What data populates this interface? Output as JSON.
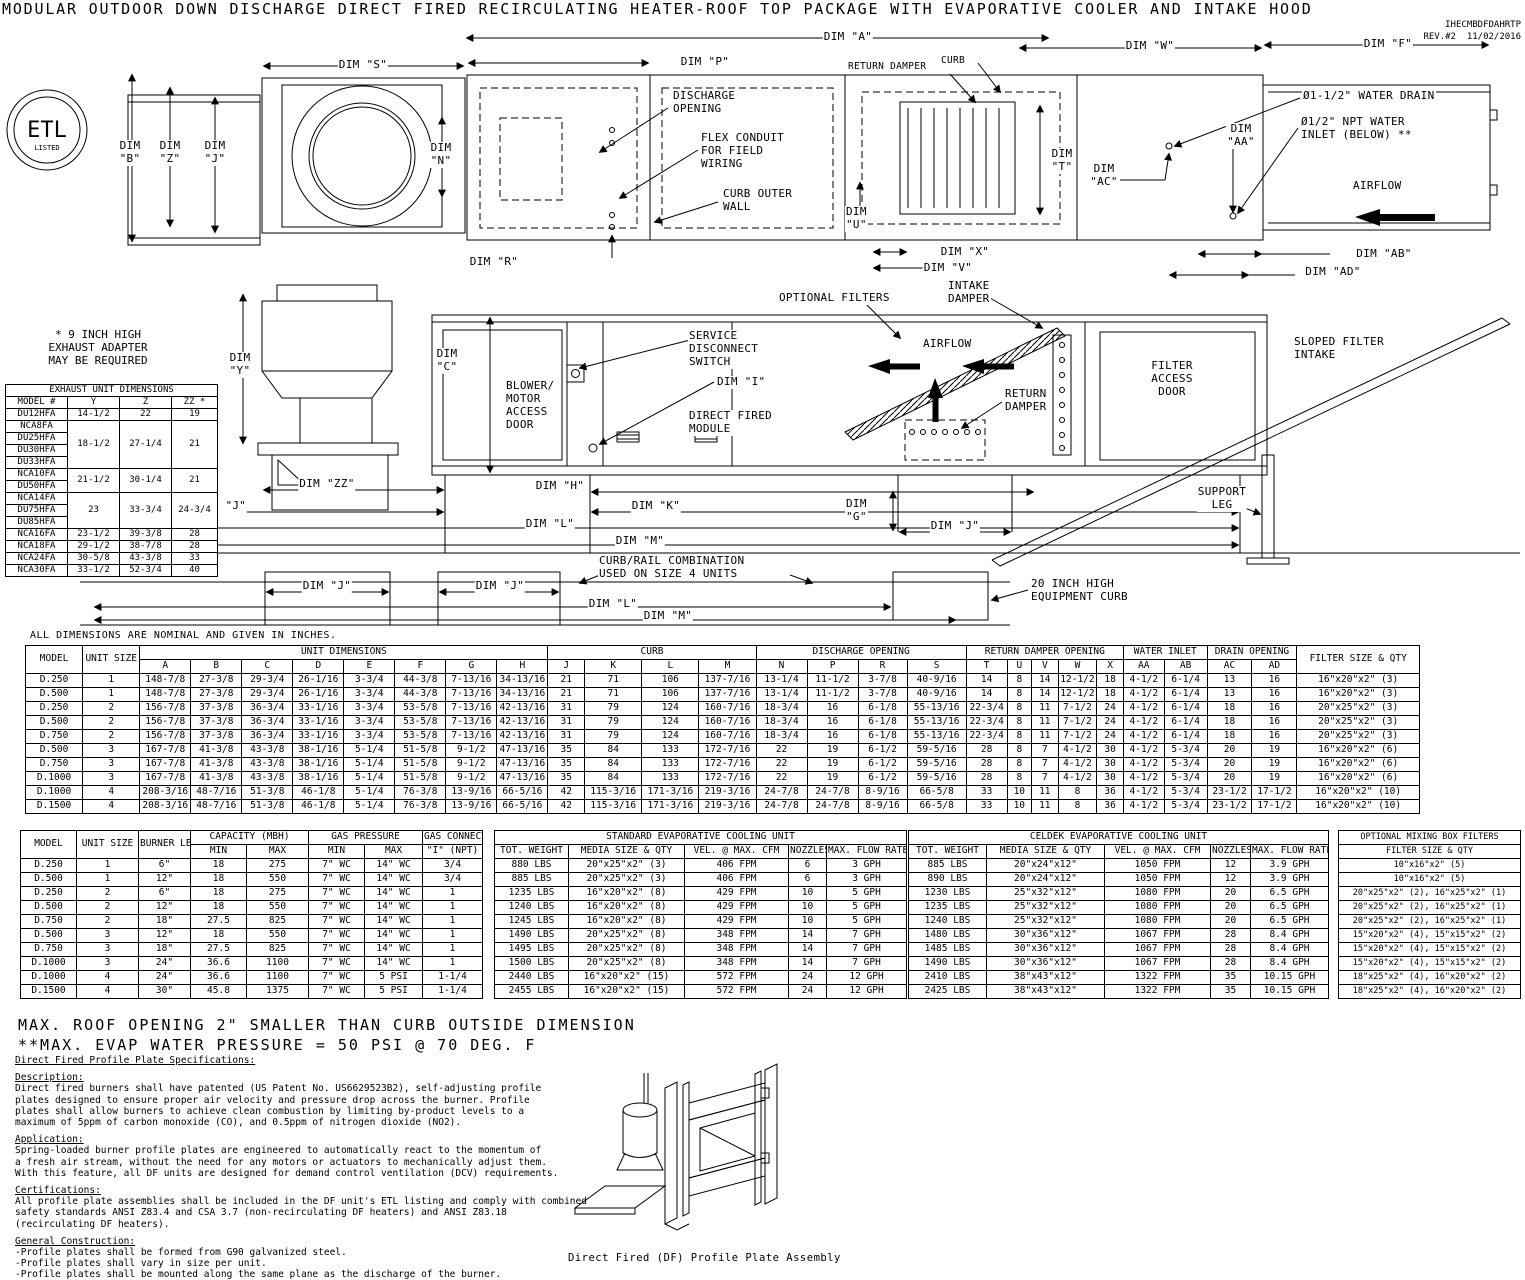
{
  "doc": {
    "title": "MODULAR OUTDOOR DOWN DISCHARGE DIRECT FIRED RECIRCULATING HEATER-ROOF TOP PACKAGE WITH EVAPORATIVE COOLER AND INTAKE HOOD",
    "ref": "IHECMBDFDAHRTP",
    "rev": "REV.#2",
    "date": "11/02/2016"
  },
  "top": {
    "dim_a": "DIM \"A\"",
    "dim_s": "DIM \"S\"",
    "dim_p": "DIM \"P\"",
    "return_damper": "RETURN DAMPER",
    "curb": "CURB",
    "dim_w": "DIM \"W\"",
    "dim_f": "DIM \"F\"",
    "dim_b": "DIM\n\"B\"",
    "dim_z": "DIM\n\"Z\"",
    "dim_j": "DIM\n\"J\"",
    "dim_n": "DIM\n\"N\"",
    "discharge_opening": "DISCHARGE\nOPENING",
    "flex_conduit": "FLEX CONDUIT\nFOR FIELD\nWIRING",
    "curb_outer_wall": "CURB OUTER\nWALL",
    "dim_t": "DIM\n\"T\"",
    "dim_ac": "DIM\n\"AC\"",
    "dim_aa": "DIM\n\"AA\"",
    "water_drain": "Ø1-1/2\" WATER DRAIN",
    "water_inlet": "Ø1/2\" NPT WATER\nINLET (BELOW) **",
    "airflow": "AIRFLOW",
    "dim_u": "DIM\n\"U\"",
    "dim_r": "DIM \"R\"",
    "dim_x": "DIM \"X\"",
    "dim_v": "DIM \"V\"",
    "dim_ab": "DIM \"AB\"",
    "dim_ad": "DIM \"AD\"",
    "etl_main": "ETL",
    "etl_sub": "LISTED"
  },
  "side": {
    "exhaust_note": "* 9 INCH HIGH\nEXHAUST ADAPTER\nMAY BE REQUIRED",
    "optional_filters": "OPTIONAL FILTERS",
    "intake_damper": "INTAKE\nDAMPER",
    "sloped_filter_intake": "SLOPED FILTER\nINTAKE",
    "dim_y": "DIM\n\"Y\"",
    "dim_c": "DIM\n\"C\"",
    "blower_door": "BLOWER/\nMOTOR\nACCESS\nDOOR",
    "service_switch": "SERVICE\nDISCONNECT\nSWITCH",
    "dim_i": "DIM \"I\"",
    "df_module": "DIRECT FIRED\nMODULE",
    "airflow": "AIRFLOW",
    "return_damper": "RETURN\nDAMPER",
    "filter_door": "FILTER\nACCESS\nDOOR",
    "support_leg": "SUPPORT\nLEG",
    "dim_zz": "DIM \"ZZ\"",
    "dim_h": "DIM \"H\"",
    "dim_j1": "DIM \"J\"",
    "dim_k": "DIM \"K\"",
    "dim_g": "DIM\n\"G\"",
    "dim_j2": "DIM \"J\"",
    "dim_l": "DIM \"L\"",
    "dim_m": "DIM \"M\"",
    "curb_rail": "CURB/RAIL COMBINATION\nUSED ON SIZE 4 UNITS",
    "dim_j3": "DIM \"J\"",
    "dim_j4": "DIM \"J\"",
    "dim_l2": "DIM \"L\"",
    "dim_m2": "DIM \"M\"",
    "equip_curb": "20 INCH HIGH\nEQUIPMENT CURB"
  },
  "notes": {
    "dims_note": "ALL DIMENSIONS ARE NOMINAL AND GIVEN IN INCHES.",
    "max_roof": "MAX. ROOF OPENING 2\" SMALLER THAN CURB OUTSIDE DIMENSION",
    "max_evap": "**MAX. EVAP WATER PRESSURE = 50 PSI @ 70 DEG. F",
    "profile_caption": "Direct Fired (DF) Profile Plate Assembly"
  },
  "exhaust_table": {
    "header_rows": [
      [
        {
          "t": "EXHAUST UNIT DIMENSIONS",
          "cs": 4
        }
      ],
      [
        "MODEL #",
        "Y",
        "Z",
        "ZZ *"
      ]
    ],
    "rows": [
      [
        "DU12HFA",
        "14-1/2",
        "22",
        "19"
      ],
      [
        "NCA8FA",
        {
          "t": "18-1/2",
          "rs": 4
        },
        {
          "t": "27-1/4",
          "rs": 4
        },
        {
          "t": "21",
          "rs": 4
        }
      ],
      [
        "DU25HFA"
      ],
      [
        "DU30HFA"
      ],
      [
        "DU33HFA"
      ],
      [
        "NCA10FA",
        {
          "t": "21-1/2",
          "rs": 2
        },
        {
          "t": "30-1/4",
          "rs": 2
        },
        {
          "t": "21",
          "rs": 2
        }
      ],
      [
        "DU50HFA"
      ],
      [
        "NCA14FA",
        {
          "t": "23",
          "rs": 3
        },
        {
          "t": "33-3/4",
          "rs": 3
        },
        {
          "t": "24-3/4",
          "rs": 3
        }
      ],
      [
        "DU75HFA"
      ],
      [
        "DU85HFA"
      ],
      [
        "NCA16FA",
        "23-1/2",
        "39-3/8",
        "28"
      ],
      [
        "NCA18FA",
        "29-1/2",
        "38-7/8",
        "28"
      ],
      [
        "NCA24FA",
        "30-5/8",
        "43-3/8",
        "33"
      ],
      [
        "NCA30FA",
        "33-1/2",
        "52-3/4",
        "40"
      ]
    ]
  },
  "main_table": {
    "header_rows": [
      [
        {
          "t": "MODEL",
          "rs": 2
        },
        {
          "t": "UNIT SIZE",
          "rs": 2
        },
        {
          "t": "UNIT DIMENSIONS",
          "cs": 8
        },
        {
          "t": "CURB",
          "cs": 4
        },
        {
          "t": "DISCHARGE OPENING",
          "cs": 4
        },
        {
          "t": "RETURN DAMPER OPENING",
          "cs": 5
        },
        {
          "t": "WATER INLET",
          "cs": 2
        },
        {
          "t": "DRAIN OPENING",
          "cs": 2
        },
        {
          "t": "FILTER SIZE & QTY",
          "rs": 2
        }
      ],
      [
        "A",
        "B",
        "C",
        "D",
        "E",
        "F",
        "G",
        "H",
        "J",
        "K",
        "L",
        "M",
        "N",
        "P",
        "R",
        "S",
        "T",
        "U",
        "V",
        "W",
        "X",
        "AA",
        "AB",
        "AC",
        "AD"
      ]
    ],
    "rows": [
      [
        "D.250",
        "1",
        "148-7/8",
        "27-3/8",
        "29-3/4",
        "26-1/16",
        "3-3/4",
        "44-3/8",
        "7-13/16",
        "34-13/16",
        "21",
        "71",
        "106",
        "137-7/16",
        "13-1/4",
        "11-1/2",
        "3-7/8",
        "40-9/16",
        "14",
        "8",
        "14",
        "12-1/2",
        "18",
        "4-1/2",
        "6-1/4",
        "13",
        "16",
        "16\"x20\"x2\" (3)"
      ],
      [
        "D.500",
        "1",
        "148-7/8",
        "27-3/8",
        "29-3/4",
        "26-1/16",
        "3-3/4",
        "44-3/8",
        "7-13/16",
        "34-13/16",
        "21",
        "71",
        "106",
        "137-7/16",
        "13-1/4",
        "11-1/2",
        "3-7/8",
        "40-9/16",
        "14",
        "8",
        "14",
        "12-1/2",
        "18",
        "4-1/2",
        "6-1/4",
        "13",
        "16",
        "16\"x20\"x2\" (3)"
      ],
      [
        "D.250",
        "2",
        "156-7/8",
        "37-3/8",
        "36-3/4",
        "33-1/16",
        "3-3/4",
        "53-5/8",
        "7-13/16",
        "42-13/16",
        "31",
        "79",
        "124",
        "160-7/16",
        "18-3/4",
        "16",
        "6-1/8",
        "55-13/16",
        "22-3/4",
        "8",
        "11",
        "7-1/2",
        "24",
        "4-1/2",
        "6-1/4",
        "18",
        "16",
        "20\"x25\"x2\" (3)"
      ],
      [
        "D.500",
        "2",
        "156-7/8",
        "37-3/8",
        "36-3/4",
        "33-1/16",
        "3-3/4",
        "53-5/8",
        "7-13/16",
        "42-13/16",
        "31",
        "79",
        "124",
        "160-7/16",
        "18-3/4",
        "16",
        "6-1/8",
        "55-13/16",
        "22-3/4",
        "8",
        "11",
        "7-1/2",
        "24",
        "4-1/2",
        "6-1/4",
        "18",
        "16",
        "20\"x25\"x2\" (3)"
      ],
      [
        "D.750",
        "2",
        "156-7/8",
        "37-3/8",
        "36-3/4",
        "33-1/16",
        "3-3/4",
        "53-5/8",
        "7-13/16",
        "42-13/16",
        "31",
        "79",
        "124",
        "160-7/16",
        "18-3/4",
        "16",
        "6-1/8",
        "55-13/16",
        "22-3/4",
        "8",
        "11",
        "7-1/2",
        "24",
        "4-1/2",
        "6-1/4",
        "18",
        "16",
        "20\"x25\"x2\" (3)"
      ],
      [
        "D.500",
        "3",
        "167-7/8",
        "41-3/8",
        "43-3/8",
        "38-1/16",
        "5-1/4",
        "51-5/8",
        "9-1/2",
        "47-13/16",
        "35",
        "84",
        "133",
        "172-7/16",
        "22",
        "19",
        "6-1/2",
        "59-5/16",
        "28",
        "8",
        "7",
        "4-1/2",
        "30",
        "4-1/2",
        "5-3/4",
        "20",
        "19",
        "16\"x20\"x2\" (6)"
      ],
      [
        "D.750",
        "3",
        "167-7/8",
        "41-3/8",
        "43-3/8",
        "38-1/16",
        "5-1/4",
        "51-5/8",
        "9-1/2",
        "47-13/16",
        "35",
        "84",
        "133",
        "172-7/16",
        "22",
        "19",
        "6-1/2",
        "59-5/16",
        "28",
        "8",
        "7",
        "4-1/2",
        "30",
        "4-1/2",
        "5-3/4",
        "20",
        "19",
        "16\"x20\"x2\" (6)"
      ],
      [
        "D.1000",
        "3",
        "167-7/8",
        "41-3/8",
        "43-3/8",
        "38-1/16",
        "5-1/4",
        "51-5/8",
        "9-1/2",
        "47-13/16",
        "35",
        "84",
        "133",
        "172-7/16",
        "22",
        "19",
        "6-1/2",
        "59-5/16",
        "28",
        "8",
        "7",
        "4-1/2",
        "30",
        "4-1/2",
        "5-3/4",
        "20",
        "19",
        "16\"x20\"x2\" (6)"
      ],
      [
        "D.1000",
        "4",
        "208-3/16",
        "48-7/16",
        "51-3/8",
        "46-1/8",
        "5-1/4",
        "76-3/8",
        "13-9/16",
        "66-5/16",
        "42",
        "115-3/16",
        "171-3/16",
        "219-3/16",
        "24-7/8",
        "24-7/8",
        "8-9/16",
        "66-5/8",
        "33",
        "10",
        "11",
        "8",
        "36",
        "4-1/2",
        "5-3/4",
        "23-1/2",
        "17-1/2",
        "16\"x20\"x2\" (10)"
      ],
      [
        "D.1500",
        "4",
        "208-3/16",
        "48-7/16",
        "51-3/8",
        "46-1/8",
        "5-1/4",
        "76-3/8",
        "13-9/16",
        "66-5/16",
        "42",
        "115-3/16",
        "171-3/16",
        "219-3/16",
        "24-7/8",
        "24-7/8",
        "8-9/16",
        "66-5/8",
        "33",
        "10",
        "11",
        "8",
        "36",
        "4-1/2",
        "5-3/4",
        "23-1/2",
        "17-1/2",
        "16\"x20\"x2\" (10)"
      ]
    ]
  },
  "burner_table": {
    "header_rows": [
      [
        {
          "t": "MODEL",
          "rs": 2
        },
        {
          "t": "UNIT SIZE",
          "rs": 2
        },
        {
          "t": "BURNER LENGTH",
          "rs": 2
        },
        {
          "t": "CAPACITY (MBH)",
          "cs": 2
        },
        {
          "t": "GAS PRESSURE",
          "cs": 2
        },
        {
          "t": "GAS CONNECTION"
        }
      ],
      [
        "MIN",
        "MAX",
        "MIN",
        "MAX",
        "\"I\" (NPT)"
      ]
    ],
    "rows": [
      [
        "D.250",
        "1",
        "6\"",
        "18",
        "275",
        "7\" WC",
        "14\" WC",
        "3/4"
      ],
      [
        "D.500",
        "1",
        "12\"",
        "18",
        "550",
        "7\" WC",
        "14\" WC",
        "3/4"
      ],
      [
        "D.250",
        "2",
        "6\"",
        "18",
        "275",
        "7\" WC",
        "14\" WC",
        "1"
      ],
      [
        "D.500",
        "2",
        "12\"",
        "18",
        "550",
        "7\" WC",
        "14\" WC",
        "1"
      ],
      [
        "D.750",
        "2",
        "18\"",
        "27.5",
        "825",
        "7\" WC",
        "14\" WC",
        "1"
      ],
      [
        "D.500",
        "3",
        "12\"",
        "18",
        "550",
        "7\" WC",
        "14\" WC",
        "1"
      ],
      [
        "D.750",
        "3",
        "18\"",
        "27.5",
        "825",
        "7\" WC",
        "14\" WC",
        "1"
      ],
      [
        "D.1000",
        "3",
        "24\"",
        "36.6",
        "1100",
        "7\" WC",
        "14\" WC",
        "1"
      ],
      [
        "D.1000",
        "4",
        "24\"",
        "36.6",
        "1100",
        "7\" WC",
        "5 PSI",
        "1-1/4"
      ],
      [
        "D.1500",
        "4",
        "30\"",
        "45.8",
        "1375",
        "7\" WC",
        "5 PSI",
        "1-1/4"
      ]
    ]
  },
  "std_evap_table": {
    "header_rows": [
      [
        {
          "t": "STANDARD EVAPORATIVE COOLING UNIT",
          "cs": 5
        }
      ],
      [
        "TOT. WEIGHT",
        "MEDIA SIZE & QTY",
        "VEL. @ MAX. CFM",
        "NOZZLES",
        "MAX. FLOW RATE"
      ]
    ],
    "rows": [
      [
        "880 LBS",
        "20\"x25\"x2\" (3)",
        "406 FPM",
        "6",
        "3 GPH"
      ],
      [
        "885 LBS",
        "20\"x25\"x2\" (3)",
        "406 FPM",
        "6",
        "3 GPH"
      ],
      [
        "1235 LBS",
        "16\"x20\"x2\" (8)",
        "429 FPM",
        "10",
        "5 GPH"
      ],
      [
        "1240 LBS",
        "16\"x20\"x2\" (8)",
        "429 FPM",
        "10",
        "5 GPH"
      ],
      [
        "1245 LBS",
        "16\"x20\"x2\" (8)",
        "429 FPM",
        "10",
        "5 GPH"
      ],
      [
        "1490 LBS",
        "20\"x25\"x2\" (8)",
        "348 FPM",
        "14",
        "7 GPH"
      ],
      [
        "1495 LBS",
        "20\"x25\"x2\" (8)",
        "348 FPM",
        "14",
        "7 GPH"
      ],
      [
        "1500 LBS",
        "20\"x25\"x2\" (8)",
        "348 FPM",
        "14",
        "7 GPH"
      ],
      [
        "2440 LBS",
        "16\"x20\"x2\" (15)",
        "572 FPM",
        "24",
        "12 GPH"
      ],
      [
        "2455 LBS",
        "16\"x20\"x2\" (15)",
        "572 FPM",
        "24",
        "12 GPH"
      ]
    ]
  },
  "celdek_table": {
    "header_rows": [
      [
        {
          "t": "CELDEK EVAPORATIVE COOLING UNIT",
          "cs": 5
        }
      ],
      [
        "TOT. WEIGHT",
        "MEDIA SIZE & QTY",
        "VEL. @ MAX. CFM",
        "NOZZLES",
        "MAX. FLOW RATE"
      ]
    ],
    "rows": [
      [
        "885 LBS",
        "20\"x24\"x12\"",
        "1050 FPM",
        "12",
        "3.9 GPH"
      ],
      [
        "890 LBS",
        "20\"x24\"x12\"",
        "1050 FPM",
        "12",
        "3.9 GPH"
      ],
      [
        "1230 LBS",
        "25\"x32\"x12\"",
        "1080 FPM",
        "20",
        "6.5 GPH"
      ],
      [
        "1235 LBS",
        "25\"x32\"x12\"",
        "1080 FPM",
        "20",
        "6.5 GPH"
      ],
      [
        "1240 LBS",
        "25\"x32\"x12\"",
        "1080 FPM",
        "20",
        "6.5 GPH"
      ],
      [
        "1480 LBS",
        "30\"x36\"x12\"",
        "1067 FPM",
        "28",
        "8.4 GPH"
      ],
      [
        "1485 LBS",
        "30\"x36\"x12\"",
        "1067 FPM",
        "28",
        "8.4 GPH"
      ],
      [
        "1490 LBS",
        "30\"x36\"x12\"",
        "1067 FPM",
        "28",
        "8.4 GPH"
      ],
      [
        "2410 LBS",
        "38\"x43\"x12\"",
        "1322 FPM",
        "35",
        "10.15 GPH"
      ],
      [
        "2425 LBS",
        "38\"x43\"x12\"",
        "1322 FPM",
        "35",
        "10.15 GPH"
      ]
    ]
  },
  "mixing_table": {
    "header_rows": [
      [
        {
          "t": "OPTIONAL MIXING BOX FILTERS"
        }
      ],
      [
        {
          "t": "FILTER SIZE & QTY"
        }
      ]
    ],
    "rows": [
      [
        "10\"x16\"x2\" (5)"
      ],
      [
        "10\"x16\"x2\" (5)"
      ],
      [
        "20\"x25\"x2\" (2), 16\"x25\"x2\" (1)"
      ],
      [
        "20\"x25\"x2\" (2), 16\"x25\"x2\" (1)"
      ],
      [
        "20\"x25\"x2\" (2), 16\"x25\"x2\" (1)"
      ],
      [
        "15\"x20\"x2\" (4), 15\"x15\"x2\" (2)"
      ],
      [
        "15\"x20\"x2\" (4), 15\"x15\"x2\" (2)"
      ],
      [
        "15\"x20\"x2\" (4), 15\"x15\"x2\" (2)"
      ],
      [
        "18\"x25\"x2\" (4), 16\"x20\"x2\" (2)"
      ],
      [
        "18\"x25\"x2\" (4), 16\"x20\"x2\" (2)"
      ]
    ]
  },
  "specs": {
    "title": "Direct Fired Profile Plate Specifications:",
    "sections": [
      {
        "h": "Description:",
        "p": "Direct fired burners shall have patented (US Patent No. US6629523B2), self-adjusting profile\nplates designed to ensure proper air velocity and pressure drop across the burner. Profile\nplates shall allow burners to achieve clean combustion by limiting by-product levels to a\nmaximum of 5ppm of carbon monoxide (CO), and 0.5ppm of nitrogen dioxide (NO2)."
      },
      {
        "h": "Application:",
        "p": "Spring-loaded burner profile plates are engineered to automatically react to the momentum of\na fresh air stream, without the need for any motors or actuators to mechanically adjust them.\nWith this feature, all DF units are designed for demand control ventilation (DCV) requirements."
      },
      {
        "h": "Certifications:",
        "p": "All profile plate assemblies shall be included in the DF unit's ETL listing and comply with combined\nsafety standards ANSI Z83.4 and CSA 3.7 (non-recirculating DF heaters) and ANSI Z83.18\n(recirculating DF heaters)."
      },
      {
        "h": "General Construction:",
        "p": "-Profile plates shall be formed from G90 galvanized steel.\n-Profile plates shall vary in size per unit.\n-Profile plates shall be mounted along the same plane as the discharge of the burner.\n-Design shall incorporate properly torqued, permanently mounted spring hinges.\n-Spring hinges shall be made from plated steel."
      }
    ]
  }
}
